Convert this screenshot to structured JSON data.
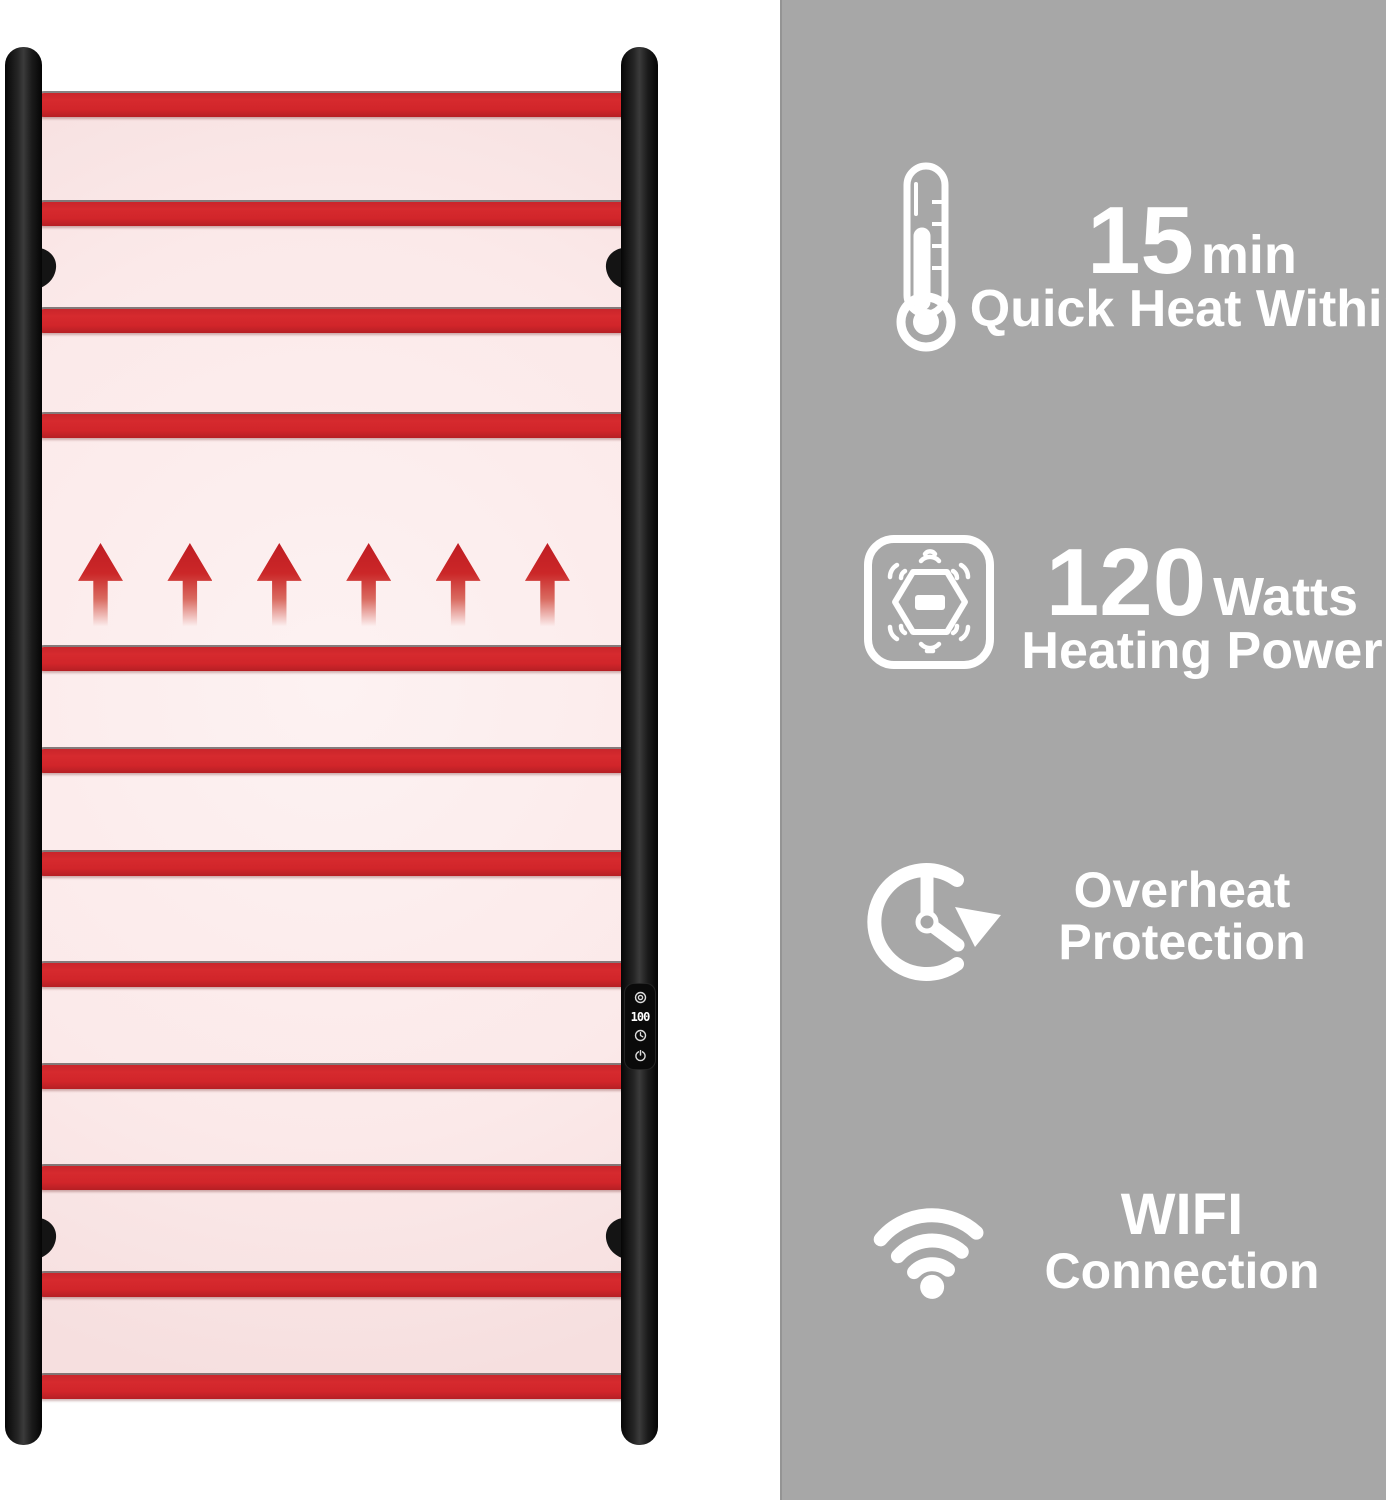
{
  "features": [
    {
      "icon": "thermometer-icon",
      "big": "15",
      "small": "min",
      "line2": "Quick Heat Within"
    },
    {
      "icon": "heating-power-icon",
      "big": "120",
      "small": "Watts",
      "line2": "Heating Power"
    },
    {
      "icon": "overheat-protection-icon",
      "line1": "Overheat",
      "line2": "Protection"
    },
    {
      "icon": "wifi-icon",
      "line1": "WIFI",
      "line2": "Connection"
    }
  ],
  "product": {
    "type": "heated towel warmer rail",
    "display_value": "100",
    "control_icons": [
      "temp-dial-icon",
      "timer-clock-icon",
      "power-icon"
    ],
    "rung_count": 12,
    "heat_arrow_count": 6
  },
  "colors": {
    "panel_gray": "#a7a7a7",
    "accent_red": "#d1252a",
    "glow_pink": "#fbe9e9",
    "rail_black": "#161616",
    "text_white": "#ffffff"
  }
}
